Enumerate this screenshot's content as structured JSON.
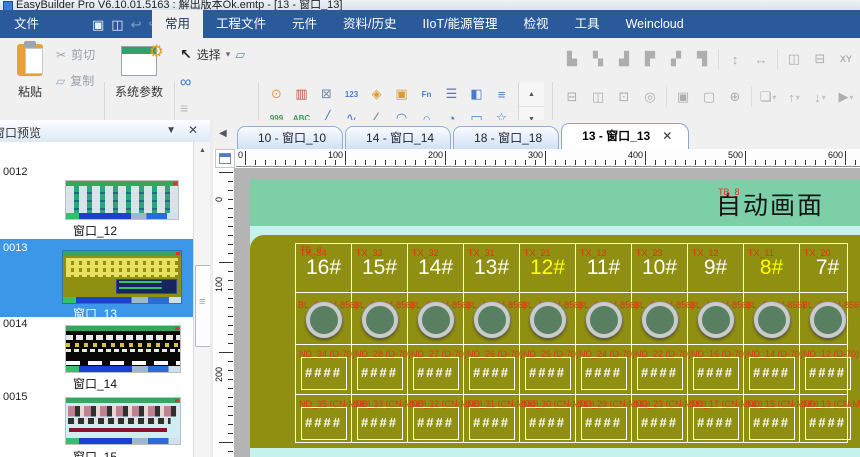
{
  "window": {
    "title": "EasyBuilder Pro V6.10.01.5163 : 解出版本Ok.emtp - [13 - 窗口_13]"
  },
  "menubar": {
    "file": "文件",
    "quick_icons": [
      {
        "name": "save-icon",
        "glyph": "▣",
        "disabled": false
      },
      {
        "name": "compile-icon",
        "glyph": "◫",
        "disabled": false
      },
      {
        "name": "undo-icon",
        "glyph": "↩",
        "disabled": true
      },
      {
        "name": "redo-icon",
        "glyph": "↪",
        "disabled": true
      },
      {
        "name": "quickbar-caret-icon",
        "glyph": "▾",
        "disabled": false
      }
    ],
    "tabs": [
      {
        "label": "常用",
        "active": true
      },
      {
        "label": "工程文件",
        "active": false
      },
      {
        "label": "元件",
        "active": false
      },
      {
        "label": "资料/历史",
        "active": false
      },
      {
        "label": "IIoT/能源管理",
        "active": false
      },
      {
        "label": "检视",
        "active": false
      },
      {
        "label": "工具",
        "active": false
      },
      {
        "label": "Weincloud",
        "active": false
      }
    ]
  },
  "ribbon": {
    "paste": "粘贴",
    "cut": "剪切",
    "copy": "复制",
    "system_params": "系统参数",
    "select": "选择",
    "cut_icon": "✂",
    "copy_icon": "▱",
    "cursor_icon": "↖",
    "select_caret": "▾",
    "multi_window_icon": "▱",
    "link_icon": "∞",
    "duplicate_icon": "≡",
    "tool_grid": [
      [
        {
          "name": "bit-lamp-icon",
          "glyph": "⊙",
          "color": "#e09a35"
        },
        {
          "name": "word-lamp-icon",
          "glyph": "▥",
          "color": "#c55040"
        },
        {
          "name": "set-bit-icon",
          "glyph": "⊠",
          "color": "#7a8ca5"
        },
        {
          "name": "set-word-icon",
          "glyph": "123",
          "color": "#4d7cc7",
          "text": true
        },
        {
          "name": "function-key-icon",
          "glyph": "◈",
          "color": "#e09a35"
        },
        {
          "name": "toggle-switch-icon",
          "glyph": "▣",
          "color": "#e09a35"
        },
        {
          "name": "macro-button-icon",
          "glyph": "Fn",
          "color": "#4d7cc7",
          "text": true
        },
        {
          "name": "combo-button-icon",
          "glyph": "☰",
          "color": "#4d7cc7"
        },
        {
          "name": "slider-icon",
          "glyph": "◧",
          "color": "#4d7cc7"
        },
        {
          "name": "option-list-icon",
          "glyph": "≡",
          "color": "#4d7cc7"
        }
      ],
      [
        {
          "name": "numeric-display-icon",
          "glyph": "999",
          "color": "#3d9e57",
          "text": true
        },
        {
          "name": "ascii-display-icon",
          "glyph": "ABC",
          "color": "#3d9e57",
          "text": true
        },
        {
          "name": "line-icon",
          "glyph": "╱",
          "color": "#4d7cc7"
        },
        {
          "name": "spline-icon",
          "glyph": "∿",
          "color": "#4d7cc7"
        },
        {
          "name": "polyline-icon",
          "glyph": "∠",
          "color": "#8a95a5"
        },
        {
          "name": "arc-icon",
          "glyph": "◠",
          "color": "#4d7cc7"
        },
        {
          "name": "circle-icon",
          "glyph": "○",
          "color": "#4d7cc7"
        },
        {
          "name": "pie-icon",
          "glyph": "◔",
          "color": "#4d7cc7"
        },
        {
          "name": "rectangle-icon",
          "glyph": "▭",
          "color": "#4d7cc7"
        },
        {
          "name": "star-icon",
          "glyph": "☆",
          "color": "#4d7cc7"
        }
      ],
      [
        {
          "name": "backlight-icon",
          "glyph": "☀",
          "color": "#9aa5b0"
        },
        {
          "name": "text-icon",
          "glyph": "A",
          "color": "#222222",
          "text2": true
        },
        {
          "name": "picture-icon",
          "glyph": "◪",
          "color": "#3d9e57"
        },
        {
          "name": "frame-icon",
          "glyph": "▢",
          "color": "#9cc3e8"
        },
        {
          "name": "table-icon",
          "glyph": "⊞",
          "color": "#8a95a5"
        },
        {
          "name": "bit-lamp-2-icon",
          "glyph": "⊙",
          "color": "#e09a35"
        },
        {
          "name": "word-lamp-2-icon",
          "glyph": "▥",
          "color": "#c55040"
        },
        {
          "name": "set-bit-2-icon",
          "glyph": "⊠",
          "color": "#7a8ca5"
        },
        {
          "name": "set-word-2-icon",
          "glyph": "123",
          "color": "#4d7cc7",
          "text": true
        },
        {
          "name": "function-key-2-icon",
          "glyph": "◈",
          "color": "#e09a35"
        }
      ]
    ],
    "tool_scroll": [
      {
        "name": "tool-scroll-up-icon",
        "glyph": "▲"
      },
      {
        "name": "tool-scroll-down-icon",
        "glyph": "▼"
      },
      {
        "name": "tool-gallery-expand-icon",
        "glyph": "▼"
      }
    ],
    "align_row1": [
      {
        "name": "align-left-icon",
        "glyph": "▙"
      },
      {
        "name": "align-center-icon",
        "glyph": "▚"
      },
      {
        "name": "align-right-icon",
        "glyph": "▟"
      },
      {
        "name": "align-top-icon",
        "glyph": "▛"
      },
      {
        "name": "align-middle-icon",
        "glyph": "▞"
      },
      {
        "name": "align-bottom-icon",
        "glyph": "▜"
      },
      {
        "name": "same-height-icon",
        "glyph": "↕",
        "sep": true
      },
      {
        "name": "same-width-icon",
        "glyph": "↔"
      },
      {
        "name": "h-spacing-icon",
        "glyph": "◫",
        "sep": true
      },
      {
        "name": "v-spacing-icon",
        "glyph": "⊟"
      },
      {
        "name": "xy-position-icon",
        "glyph": "XY",
        "xy": true
      }
    ],
    "align_row2": [
      {
        "name": "same-width-size-icon",
        "glyph": "⊟"
      },
      {
        "name": "same-height-size-icon",
        "glyph": "◫"
      },
      {
        "name": "same-size-icon",
        "glyph": "⊡"
      },
      {
        "name": "transform-icon",
        "glyph": "◎"
      },
      {
        "name": "group-icon",
        "glyph": "▣",
        "sep": true
      },
      {
        "name": "ungroup-icon",
        "glyph": "▢"
      },
      {
        "name": "pin-icon",
        "glyph": "⊕"
      },
      {
        "name": "bring-to-front-icon",
        "glyph": "❏",
        "caret": true,
        "sep": true
      },
      {
        "name": "move-up-layer-icon",
        "glyph": "↑",
        "caret": true
      },
      {
        "name": "move-down-layer-icon",
        "glyph": "↓",
        "caret": true
      },
      {
        "name": "flip-icon",
        "glyph": "▶",
        "caret": true
      }
    ]
  },
  "left_panel": {
    "title": "窗口预览",
    "caret_icon": "▼",
    "close_icon": "✕",
    "scroll_up_icon": "▲",
    "items": [
      {
        "id": "0012",
        "name": "窗口_12",
        "selected": false
      },
      {
        "id": "0013",
        "name": "窗口_13",
        "selected": true
      },
      {
        "id": "0014",
        "name": "窗口_14",
        "selected": false
      },
      {
        "id": "0015",
        "name": "窗口_15",
        "selected": false
      }
    ],
    "partial_next_id": "0016"
  },
  "doc_tabs": {
    "nav_left_icon": "◀",
    "close_icon": "✕",
    "items": [
      {
        "label": "10 - 窗口_10",
        "active": false
      },
      {
        "label": "14 - 窗口_14",
        "active": false
      },
      {
        "label": "18 - 窗口_18",
        "active": false
      },
      {
        "label": "13 - 窗口_13",
        "active": true
      }
    ]
  },
  "ruler": {
    "h_labels": [
      0,
      100,
      200,
      300,
      400,
      500,
      600
    ],
    "v_labels": [
      0,
      100,
      200
    ]
  },
  "screen": {
    "title": "自动画面",
    "title_tag": "TB_8",
    "grid_tag": "TB_0",
    "nd_placeholder": "####",
    "columns": [
      {
        "num": "16#",
        "num_color": "#ffffff",
        "tx": "TX_34",
        "bl": "BL_29 (M-856)",
        "nd1": "ND_34 (D-70)",
        "nd2": "ND_35 (CN-MD6)"
      },
      {
        "num": "15#",
        "num_color": "#ffffff",
        "tx": "TX_33",
        "bl": "BL_23 (M-856)",
        "nd1": "ND_28 (D-70)",
        "nd2": "ND_33 (CN-MD5)"
      },
      {
        "num": "14#",
        "num_color": "#ffffff",
        "tx": "TX_32",
        "bl": "BL_22 (M-856)",
        "nd1": "ND_27 (D-70)",
        "nd2": "ND_32 (CN-MD5)"
      },
      {
        "num": "13#",
        "num_color": "#ffffff",
        "tx": "TX_31",
        "bl": "BL_15 (M-856)",
        "nd1": "ND_26 (D-70)",
        "nd2": "ND_31 (CN-MD4)"
      },
      {
        "num": "12#",
        "num_color": "#ffff00",
        "tx": "TX_21",
        "bl": "BL_12 (M-856)",
        "nd1": "ND_25 (D-70)",
        "nd2": "ND_30 (CN-MD3)"
      },
      {
        "num": "11#",
        "num_color": "#ffffff",
        "tx": "TX_13",
        "bl": "BL_21 (M-856)",
        "nd1": "ND_24 (D-70)",
        "nd2": "ND_29 (CN-MD2)"
      },
      {
        "num": "10#",
        "num_color": "#ffffff",
        "tx": "TX_23",
        "bl": "BL_20 (M-856)",
        "nd1": "ND_22 (D-70)",
        "nd2": "ND_23 (CN-MD1)"
      },
      {
        "num": "9#",
        "num_color": "#ffffff",
        "tx": "TX_12",
        "bl": "BL_19 (M-856)",
        "nd1": "ND_16 (D-70)",
        "nd2": "ND_17 (CN-MD0)"
      },
      {
        "num": "8#",
        "num_color": "#ffff00",
        "tx": "TX_11",
        "bl": "BL_11 (M-856)",
        "nd1": "ND_14 (D-70)",
        "nd2": "ND_15 (CN-MD9)"
      },
      {
        "num": "7#",
        "num_color": "#ffffff",
        "tx": "TX_20",
        "bl": "BL_27 (M-856)",
        "nd1": "ND_12 (D-70)",
        "nd2": "ND_13 (CN-MD8)"
      }
    ]
  },
  "colors": {
    "menubar_blue": "#2b5a9b",
    "selection_blue": "#3d97e8",
    "screen_teal": "#7ccfa7",
    "screen_cyan": "#c6f2ee",
    "screen_olive": "#8f8f12",
    "tag_red": "#e53317",
    "lamp_green": "#587f62"
  }
}
